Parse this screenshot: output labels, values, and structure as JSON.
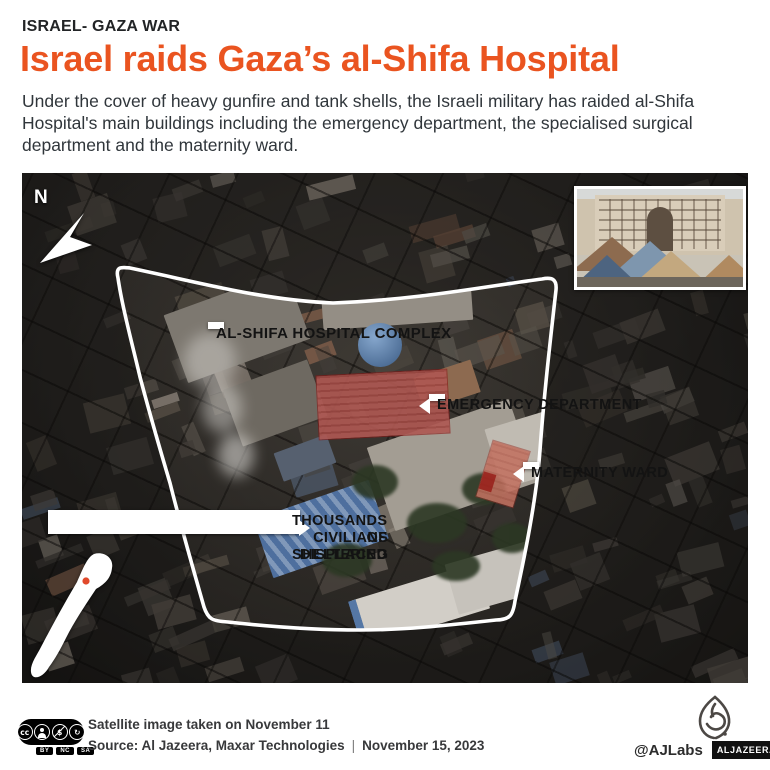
{
  "header": {
    "kicker": "ISRAEL- GAZA WAR",
    "title": "Israel raids Gaza’s al-Shifa Hospital",
    "intro": "Under the cover of heavy gunfire and tank shells, the Israeli military has raided al-Shifa Hospital's main buildings including the emergency department, the specialised surgical department and the maternity ward."
  },
  "map": {
    "compass": "N",
    "labels": {
      "complex": "AL-SHIFA HOSPITAL COMPLEX",
      "emergency": "EMERGENCY DEPARTMENT",
      "maternity": "MATERNITY WARD",
      "displaced_line1": "THOUSANDS OF DISPLACED",
      "displaced_line2": "CIVILIANS SHELTERING"
    }
  },
  "footer": {
    "license": {
      "cc": "cc",
      "tags": [
        "BY",
        "NC",
        "SA"
      ]
    },
    "caption_line1": "Satellite image taken on November 11",
    "source_label": "Source: Al Jazeera, Maxar Technologies",
    "separator": "|",
    "date": "November 15, 2023",
    "handle": "@AJLabs",
    "brand": "ALJAZEERA"
  },
  "colors": {
    "accent_orange": "#ea5420",
    "highlight_red": "#a81e1c",
    "label_bg": "#ffffff",
    "label_text": "#131313"
  }
}
